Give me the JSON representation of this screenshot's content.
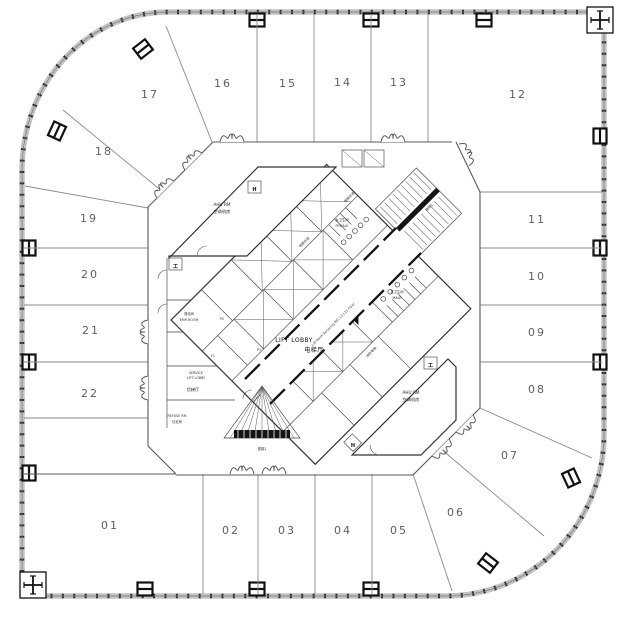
{
  "plan": {
    "zones": [
      "01",
      "02",
      "03",
      "04",
      "05",
      "06",
      "07",
      "08",
      "09",
      "10",
      "11",
      "12",
      "13",
      "14",
      "15",
      "16",
      "17",
      "18",
      "19",
      "20",
      "21",
      "22"
    ],
    "core": {
      "lift_lobby_en": "LIFT LOBBY",
      "lift_lobby_cn": "电梯厅",
      "ahu_en": "AHU RM",
      "ahu_cn": "空调机房",
      "female_cn": "女卫生间",
      "female_en": "FEMALE",
      "male_cn": "男卫生间",
      "male_en": "MALE",
      "service_lift_en1": "SERVICE",
      "service_lift_en2": "LIFT LOBBY",
      "service_lift_cn": "货梯厅",
      "refuse_en": "REFUSE RM",
      "refuse_cn": "垃圾房",
      "emr_cn": "强电间",
      "emr_en": "EMR ROOM",
      "lift_bank_note": "Lift Bank Servicing NO. L2-L11 Floor",
      "shaft_cn": "电梯井道",
      "fire_lift_cn": "消防电梯",
      "stair1_cn": "楼梯1",
      "stair2_cn": "楼梯2",
      "lift_p1": "P1",
      "lift_p2": "P2",
      "lift_f1": "F1"
    },
    "markers": {
      "hose_reel": "H",
      "beam": "工"
    }
  }
}
